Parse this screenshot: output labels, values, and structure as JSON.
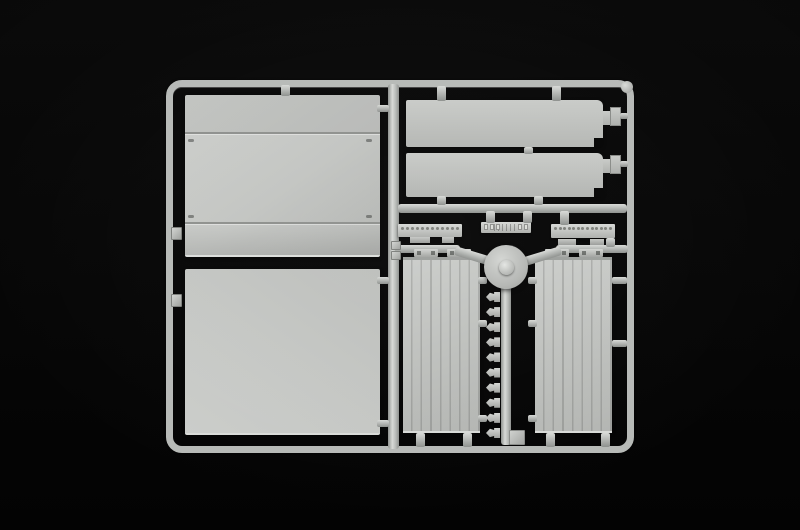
{
  "image": {
    "type": "photograph",
    "subject": "Injection-moulded light grey plastic model-kit sprue (runner frame with flat trailer panels and small parts) on a black background",
    "orientation": "landscape",
    "visible_text": ""
  },
  "colors": {
    "bg": "#060606",
    "sprue": "#b7bab7",
    "sprue-hi": "#d8dad7",
    "sprue-dk": "#8e918e",
    "panel": "#c3c5c2",
    "panel-hi": "#cdcfcc",
    "panel-dk": "#b2b4b1",
    "seam": "#8f918e",
    "detail": "#7e807b"
  },
  "parts": {
    "frame": "outer rectangular runner frame with rounded corners",
    "center_divider": "vertical runner splitting frame into left and right bays",
    "left_upper_panel": "large flat side panel with two horizontal seam lines and corner latch marks",
    "left_lower_panel": "large plain flat side panel",
    "top_right_panel_1": "long flat roof/floor panel with right-end tab and corner notch",
    "top_right_panel_2": "long flat roof/floor panel with right-end tab and corner notch",
    "left_rivet_strip": "thin chassis strip with a row of 12 rivet details",
    "center_ribbed_strip": "short ribbed step/bumper strip with end studs",
    "right_rivet_strip": "thin chassis strip with a row of 13 rivet details",
    "hub_disc": "round disc part with centre boss at the Y runner junction",
    "left_door_panel": "vertically planked rear-door panel with two hinge bars above",
    "right_door_panel": "vertically planked rear-door panel with two hinge bars above",
    "clip_column": "column of 10 small clip/hinge parts along the centre runner",
    "bottom_square": "small square part at the foot of the centre runner",
    "rail_clips": "small square connector clips on left rail and divider"
  },
  "generated": [
    {
      "target": "rivets-left",
      "count": 12,
      "class": "rivet",
      "name": "rivet-dot"
    },
    {
      "target": "rivets-right",
      "count": 13,
      "class": "rivet",
      "name": "rivet-dot"
    },
    {
      "target": "clip-column",
      "count": 10,
      "class": "clip",
      "name": "clip-part"
    },
    {
      "target": "dots-center-left",
      "count": 3,
      "class": "dot",
      "name": "detail-stud"
    },
    {
      "target": "dots-center-right",
      "count": 2,
      "class": "dot",
      "name": "detail-stud"
    }
  ]
}
